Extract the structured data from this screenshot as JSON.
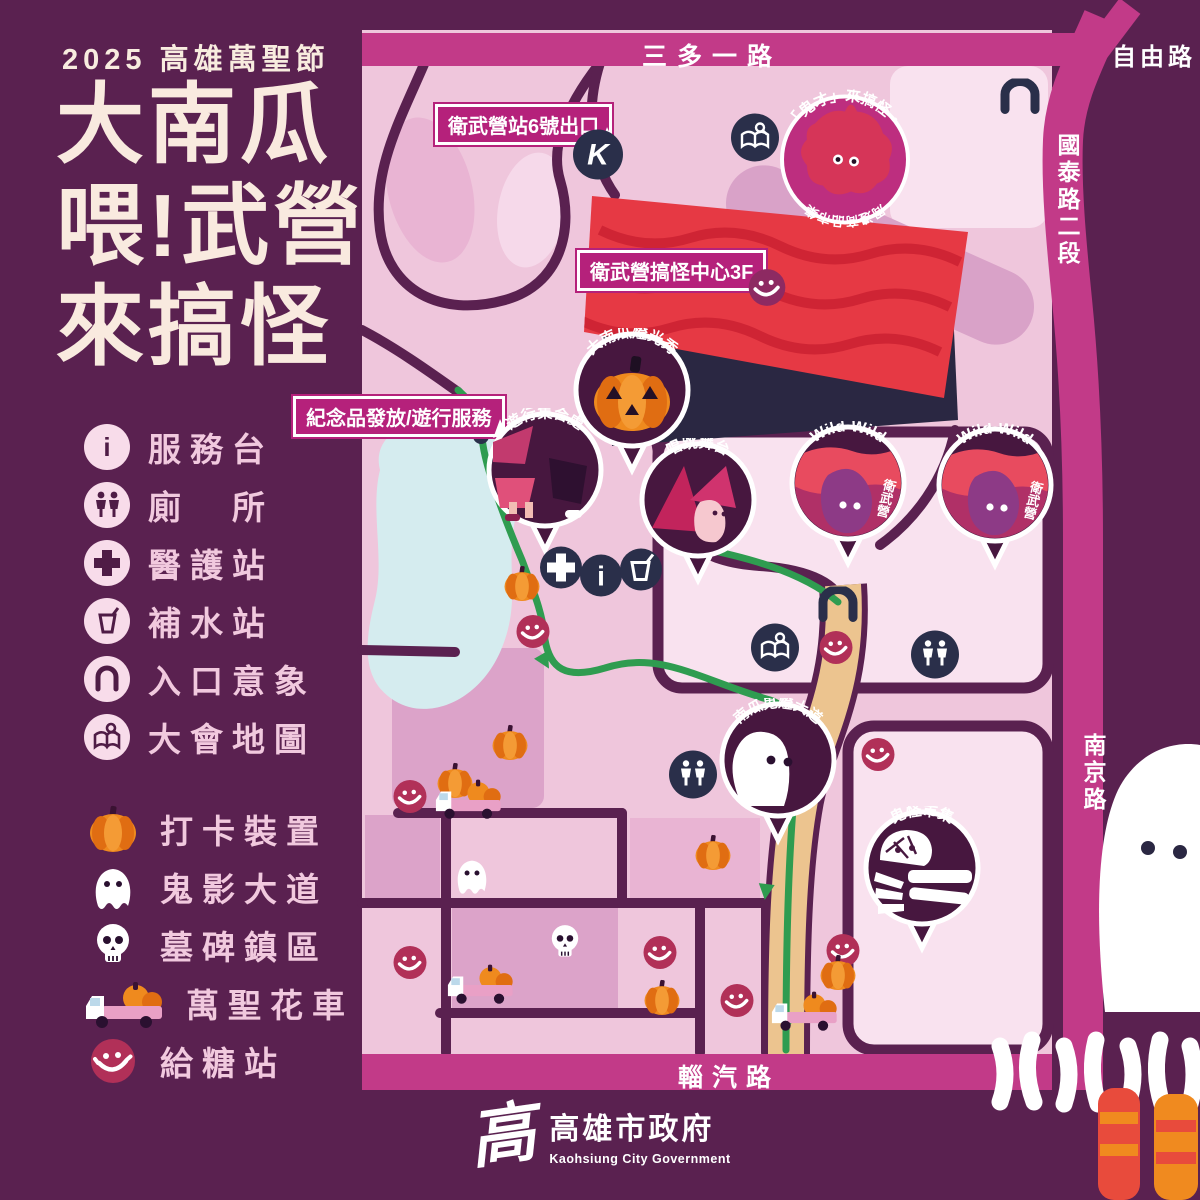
{
  "title": {
    "eyebrow": "2025 高雄萬聖節",
    "line1": "大南瓜",
    "line2": "喂!武營",
    "line3": "來搞怪"
  },
  "legend": {
    "facilities": [
      {
        "icon": "info-icon",
        "label": "服務台"
      },
      {
        "icon": "restroom-icon",
        "label": "廁　所"
      },
      {
        "icon": "medical-cross-icon",
        "label": "醫護站"
      },
      {
        "icon": "water-cup-icon",
        "label": "補水站"
      },
      {
        "icon": "entrance-arch-icon",
        "label": "入口意象"
      },
      {
        "icon": "event-map-icon",
        "label": "大會地圖"
      }
    ],
    "features": [
      {
        "icon": "pumpkin-icon",
        "label": "打卡裝置"
      },
      {
        "icon": "ghost-icon",
        "label": "鬼影大道"
      },
      {
        "icon": "skull-icon",
        "label": "墓碑鎮區"
      },
      {
        "icon": "float-truck-icon",
        "label": "萬聖花車"
      },
      {
        "icon": "smiley-icon",
        "label": "給糖站"
      }
    ]
  },
  "roads": {
    "top": "三多一路",
    "freedom": "自由路",
    "guotai": "國泰路二段",
    "nanjing": "南京路",
    "bottom": "輜汽路"
  },
  "callouts": {
    "station": "衛武營站6號出口",
    "center": "衛武營搞怪中心3F",
    "souvenir": "紀念品發放/遊行服務"
  },
  "badge": {
    "arc_top": "「鬼才」來搞怪・",
    "arc_bottom": "周邊商品市集"
  },
  "pins": {
    "pumpkin_show": "大南瓜燈光秀",
    "parade_meet": "遊行集合處",
    "stage": "唱跳舞台",
    "wild_en": "Wild Wild",
    "wild_zh": "衛武營",
    "ghost_ave": "南瓜鬼燈大道",
    "market": "鬼怪市集"
  },
  "glyphs": {
    "metro_k": "K",
    "info_i": "i"
  },
  "footer": {
    "logo_glyph": "高",
    "gov_zh": "高雄市政府",
    "gov_en": "Kaohsiung City Government"
  },
  "colors": {
    "background": "#5a2150",
    "map_pink": "#efc6dc",
    "magenta_road": "#c23a88",
    "callout_magenta": "#b5217b",
    "navy_icon": "#2a2f4a",
    "crimson_smiley": "#b13058",
    "pin_fill": "#47173f",
    "pumpkin_orange": "#ef8a1e",
    "route_green": "#2f9c50",
    "route_tan": "#ecc48f",
    "building_red": "#e63944",
    "title_cream": "#f8ecdf"
  }
}
